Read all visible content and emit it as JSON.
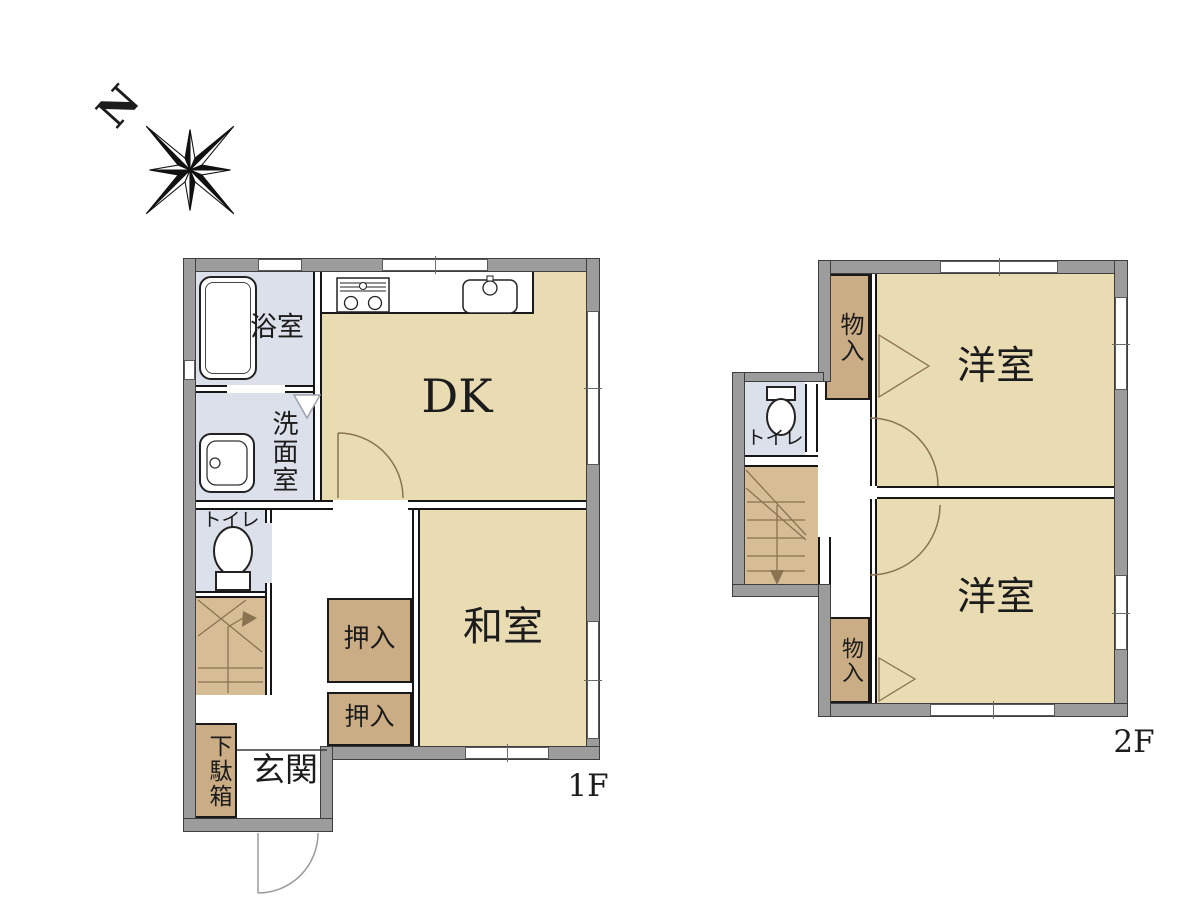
{
  "compass": {
    "north": "N"
  },
  "floor1": {
    "label": "1F",
    "rooms": {
      "bathroom": "浴室",
      "washroom": "洗面室",
      "toilet": "トイレ",
      "dining_kitchen": "DK",
      "japanese_room": "和室",
      "closet_upper": "押入",
      "closet_lower": "押入",
      "entrance": "玄関",
      "shoe_cabinet": "下駄箱"
    }
  },
  "floor2": {
    "label": "2F",
    "rooms": {
      "toilet": "トイレ",
      "storage_upper": "物入",
      "storage_lower": "物入",
      "western_room_upper": "洋室",
      "western_room_lower": "洋室"
    }
  },
  "colors": {
    "wall_fill": "#9c9c9c",
    "room_floor": "#e9dcb3",
    "closet_floor": "#cbad85",
    "stairs_floor": "#d6bd96",
    "wet_area_floor": "#dce0eb",
    "outline": "#161616",
    "door_swing": "#8a7350"
  }
}
